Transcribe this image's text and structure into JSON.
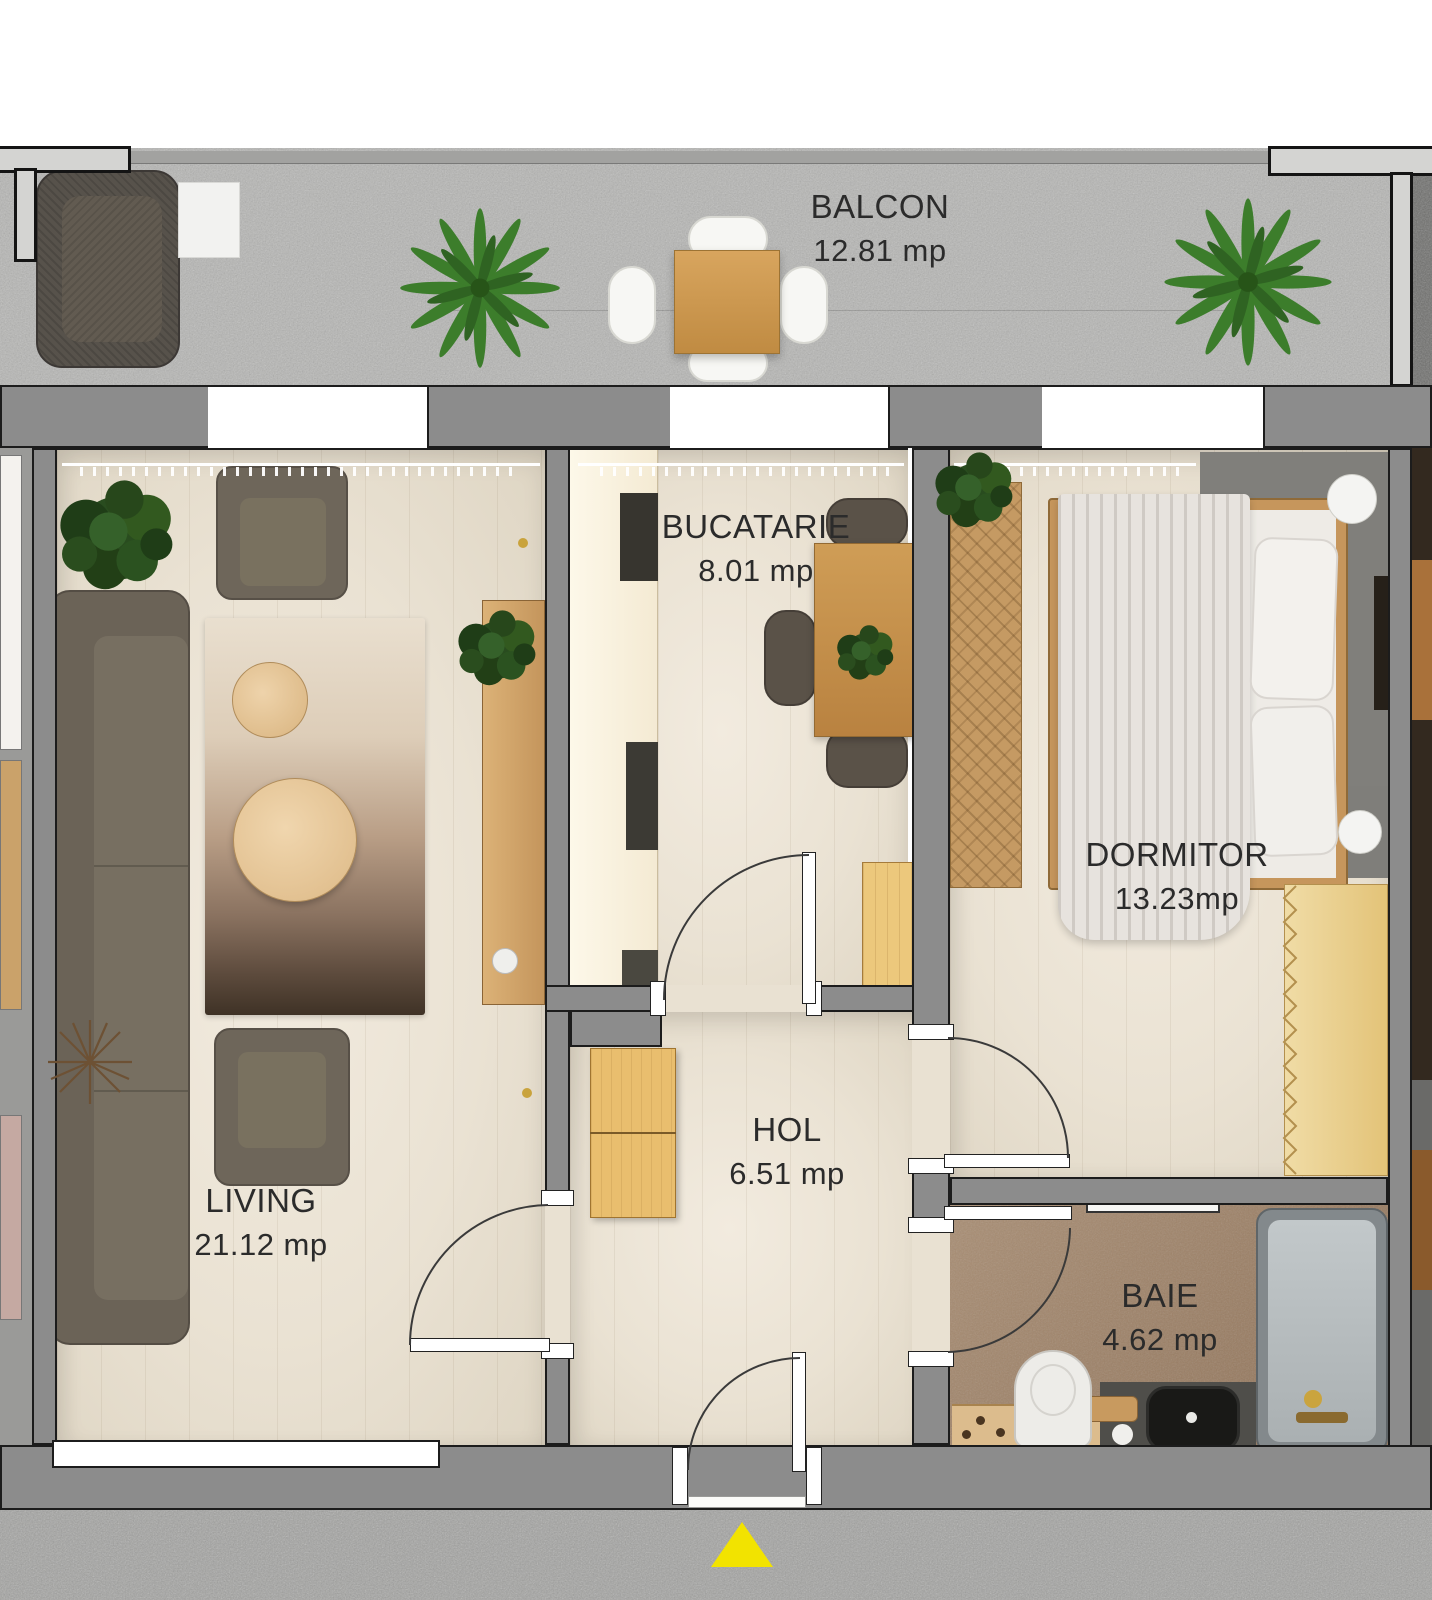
{
  "plan": {
    "type": "apartment-floor-plan",
    "unit_label": "mp",
    "rooms": {
      "balcon": {
        "name": "BALCON",
        "area": "12.81 mp"
      },
      "bucatarie": {
        "name": "BUCATARIE",
        "area": "8.01 mp"
      },
      "dormitor": {
        "name": "DORMITOR",
        "area": "13.23mp"
      },
      "living": {
        "name": "LIVING",
        "area": "21.12 mp"
      },
      "hol": {
        "name": "HOL",
        "area": "6.51 mp"
      },
      "baie": {
        "name": "BAIE",
        "area": "4.62 mp"
      }
    },
    "colors": {
      "wall_gray": "#8c8c8c",
      "outline_black": "#1c1c1c",
      "floor_wood": "#ece4d6",
      "bath_floor_brown": "#a08468",
      "balcony_concrete": "#b6b6b4",
      "entrance_marker_yellow": "#f2e300",
      "label_text": "#2b2b2b"
    }
  }
}
